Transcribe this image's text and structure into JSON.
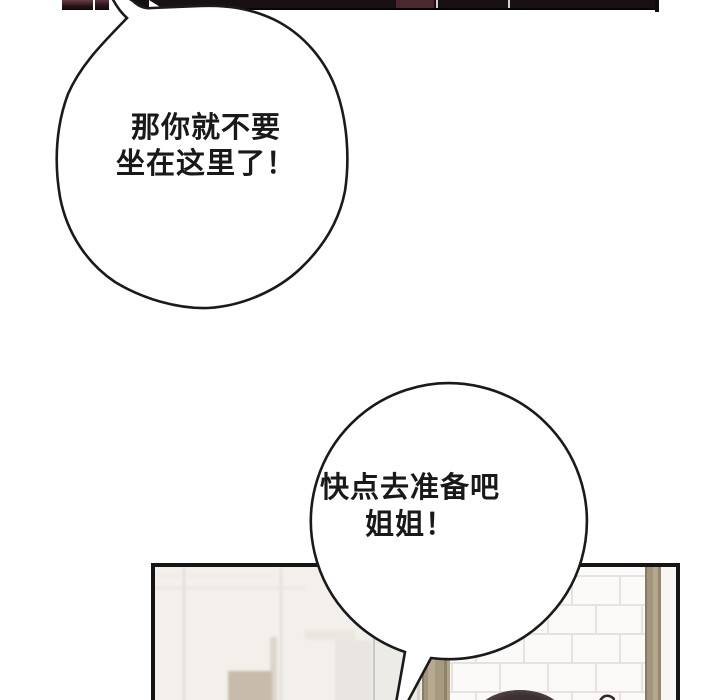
{
  "comic": {
    "bubble1": {
      "line1": "那你就不要",
      "line2": "坐在这里了！"
    },
    "bubble2": {
      "line1": "快点去准备吧",
      "line2": "姐姐！"
    }
  },
  "colors": {
    "top_bar_dark": "#181014",
    "top_bar_maroon": "#4a2830",
    "bubble_outline": "#1a1a1a",
    "bubble_fill": "#ffffff",
    "panel_border": "#151515",
    "panel_wall": "#f3f0ec",
    "door_frame_tan": "#a89a7f",
    "tile_white": "#fbfaf8",
    "tile_grout": "#e6e3df",
    "hair_dark": "#3a3134",
    "cabinet_beige": "#c9bbab"
  }
}
